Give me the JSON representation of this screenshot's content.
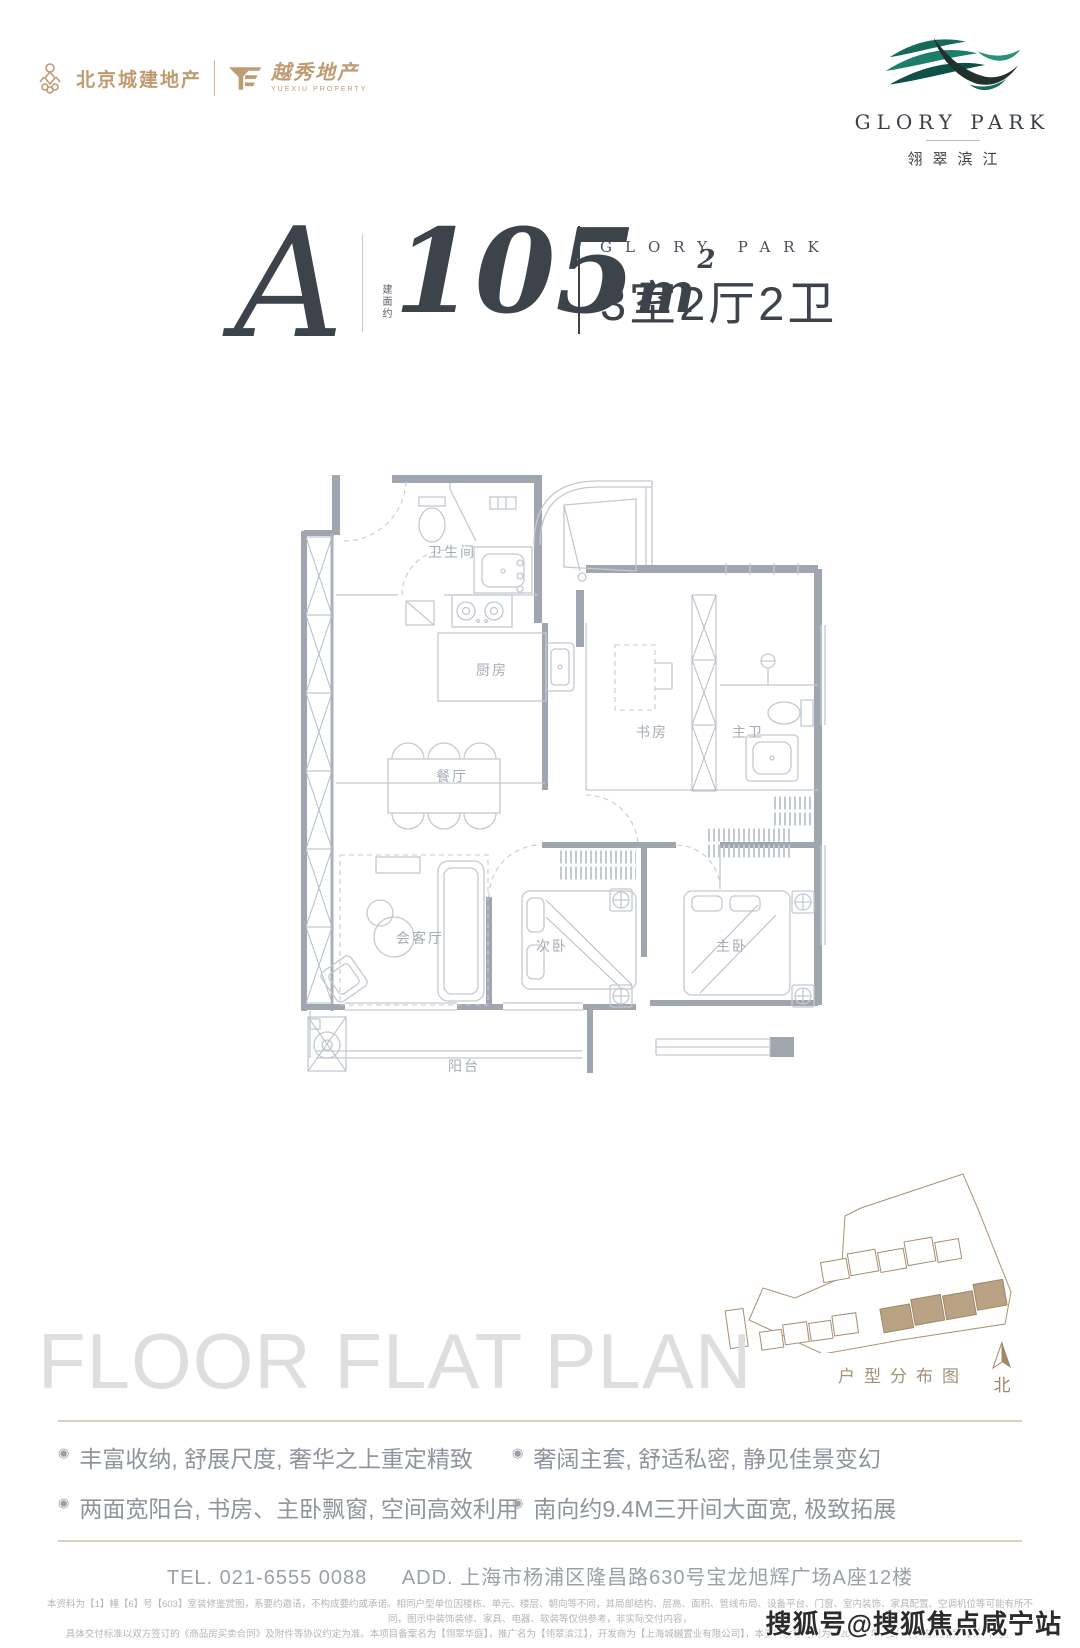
{
  "colors": {
    "brand_gold": "#bf9b72",
    "brand_teal": "#1d7a64",
    "title_dark": "#3d434b",
    "plan_gray": "#9fa6af",
    "tan_rule": "#ddd0bd"
  },
  "header": {
    "left": {
      "brand1": "北京城建地产",
      "brand2": "越秀地产",
      "brand2_sub": "YUEXIU PROPERTY"
    },
    "right": {
      "brand": "GLORY PARK",
      "brand_cn": "翎翠滨江"
    }
  },
  "title": {
    "unit": "A",
    "area_label": "建面约",
    "area_value": "105",
    "area_unit": "m",
    "area_sup": "2",
    "brand": "GLORY PARK",
    "spec": "3室2厅2卫"
  },
  "floorplan": {
    "rooms": {
      "bath": "卫生间",
      "kitchen": "厨房",
      "dining": "餐厅",
      "study": "书房",
      "master_bath": "主卫",
      "living": "会客厅",
      "bedroom2": "次卧",
      "master": "主卧",
      "balcony": "阳台"
    }
  },
  "siteplan": {
    "caption": "户型分布图",
    "north": "北"
  },
  "section_caption": "FLOOR FLAT PLAN",
  "bullet_icon": "◉",
  "features": [
    "丰富收纳, 舒展尺度, 奢华之上重定精致",
    "两面宽阳台, 书房、主卧飘窗, 空间高效利用",
    "奢阔主套, 舒适私密, 静见佳景变幻",
    "南向约9.4M三开间大面宽, 极致拓展"
  ],
  "contact": {
    "tel": "TEL. 021-6555 0088",
    "address": "ADD. 上海市杨浦区隆昌路630号宝龙旭辉广场A座12楼"
  },
  "disclaimer": {
    "line1": "本资料为【1】幢【6】号【603】室装修鉴赏图，系要约邀请，不构成要约或承诺。相同户型单位因楼栋、单元、楼层、朝向等不同，其局部结构、层高、面积、管线布局、设备平台、门窗、室内装饰、家具配置、空调机位等可能有所不同，图示中装饰装修、家具、电器、软装等仅供参考，非实际交付内容，",
    "line2": "具体交付标准以双方签订的《商品房买卖合同》及附件等协议约定为准。本项目备案名为【翎翠华庭】，推广名为【翎翠滨江】，开发商为【上海城樾置业有限公司】，本资料发布时间为【2025】年【2】月，有效期为【6】个月，"
  },
  "watermark": "搜狐号@搜狐焦点咸宁站"
}
